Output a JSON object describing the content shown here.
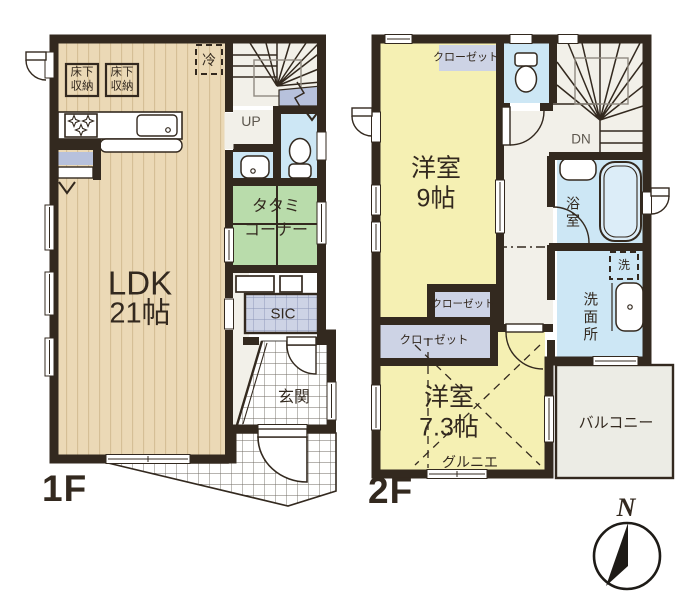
{
  "floor1": {
    "label": "1F",
    "ldk": {
      "name": "LDK",
      "size": "21帖"
    },
    "tatami": {
      "line1": "タタミ",
      "line2": "コーナー"
    },
    "underfloor_storage": {
      "line1": "床下",
      "line2": "収納"
    },
    "fridge": "冷",
    "stairs_up": "UP",
    "shoe_closet": "SIC",
    "entrance": "玄関"
  },
  "floor2": {
    "label": "2F",
    "room9": {
      "name": "洋室",
      "size": "9帖"
    },
    "room73": {
      "name": "洋室",
      "size": "7.3帖"
    },
    "closet_top": "クローゼット",
    "closet_mid": "クローゼット",
    "closet_low": "クローゼット",
    "stairs_down": "DN",
    "bathroom": "浴室",
    "washer": "洗",
    "washroom": "洗面所",
    "attic": "グルニエ",
    "balcony": "バルコニー"
  },
  "compass": {
    "north": "N"
  },
  "colors": {
    "wall": "#33291f",
    "wood_floor": "#ebd9b6",
    "tatami_green": "#b9dcab",
    "water_blue": "#cde7f5",
    "closet_gray": "#cdd3e5",
    "room_yellow": "#f5f0b3",
    "hall_white": "#f2f0e9",
    "balcony_gray": "#ecece5"
  }
}
